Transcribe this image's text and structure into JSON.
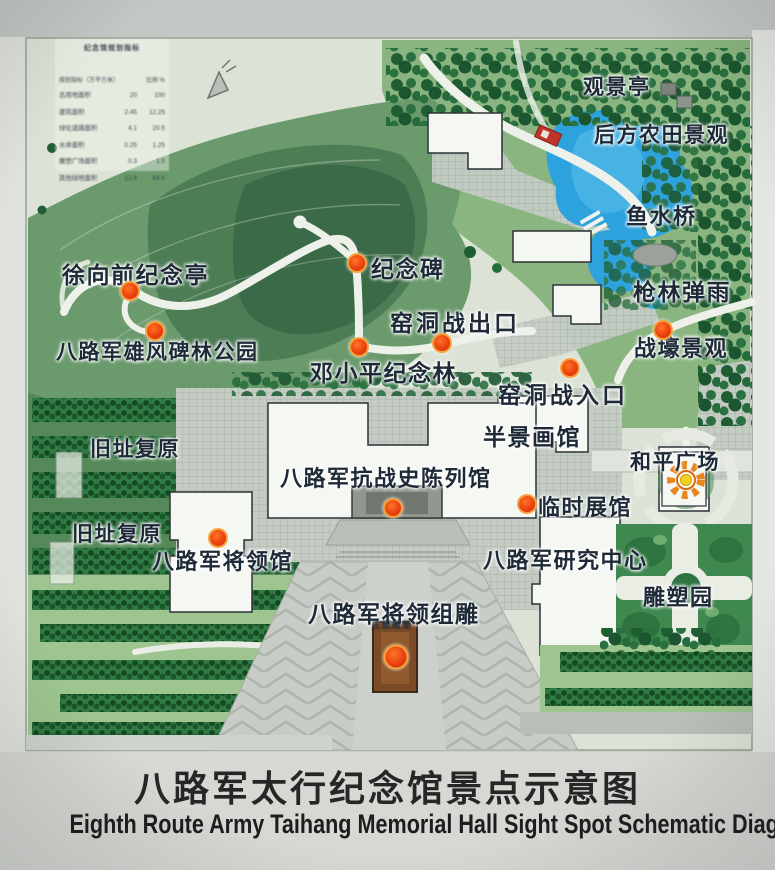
{
  "legend_table": {
    "title": "纪念馆规划指标",
    "header": {
      "name": "规划指标（万平方米）",
      "ratio": "比例 %"
    },
    "rows": [
      {
        "name": "总用地面积",
        "value": "20",
        "pct": "100"
      },
      {
        "name": "建筑面积",
        "value": "2.45",
        "pct": "12.25"
      },
      {
        "name": "绿化道路面积",
        "value": "4.1",
        "pct": "20.5"
      },
      {
        "name": "水体面积",
        "value": "0.25",
        "pct": "1.25"
      },
      {
        "name": "雕塑广场面积",
        "value": "0.3",
        "pct": "1.5"
      },
      {
        "name": "其他绿地面积",
        "value": "12.9",
        "pct": "64.5"
      }
    ]
  },
  "map": {
    "labels": [
      {
        "id": "viewing-pavilion",
        "text": "观景亭",
        "x": 583,
        "y": 71,
        "fs": 21
      },
      {
        "id": "rear-farmland-view",
        "text": "后方农田景观",
        "x": 594,
        "y": 119,
        "fs": 21
      },
      {
        "id": "fish-water-bridge",
        "text": "鱼水桥",
        "x": 626,
        "y": 199,
        "fs": 22
      },
      {
        "id": "hail-of-bullets",
        "text": "枪林弹雨",
        "x": 633,
        "y": 273,
        "fs": 23
      },
      {
        "id": "trench-landscape",
        "text": "战壕景观",
        "x": 634,
        "y": 331,
        "fs": 22
      },
      {
        "id": "monument",
        "text": "纪念碑",
        "x": 371,
        "y": 250,
        "fs": 23
      },
      {
        "id": "xuxiangqian-pavilion",
        "text": "徐向前纪念亭",
        "x": 62,
        "y": 256,
        "fs": 23
      },
      {
        "id": "cave-warfare-exit",
        "text": "窑洞战出口",
        "x": 390,
        "y": 304,
        "fs": 23,
        "ls": 3
      },
      {
        "id": "stele-forest-park",
        "text": "八路军雄风碑林公园",
        "x": 56,
        "y": 336,
        "fs": 21
      },
      {
        "id": "dengxiaoping-forest",
        "text": "邓小平纪念林",
        "x": 310,
        "y": 354,
        "fs": 23
      },
      {
        "id": "cave-warfare-entrance",
        "text": "窑洞战入口",
        "x": 498,
        "y": 376,
        "fs": 23,
        "ls": 3
      },
      {
        "id": "panorama-hall",
        "text": "半景画馆",
        "x": 483,
        "y": 418,
        "fs": 23
      },
      {
        "id": "peace-square",
        "text": "和平广场",
        "x": 630,
        "y": 446,
        "fs": 21
      },
      {
        "id": "former-site-1",
        "text": "旧址复原",
        "x": 90,
        "y": 433,
        "fs": 21
      },
      {
        "id": "war-history-hall",
        "text": "八路军抗战史陈列馆",
        "x": 280,
        "y": 461,
        "fs": 22
      },
      {
        "id": "temporary-hall",
        "text": "临时展馆",
        "x": 538,
        "y": 490,
        "fs": 22
      },
      {
        "id": "former-site-2",
        "text": "旧址复原",
        "x": 72,
        "y": 518,
        "fs": 21
      },
      {
        "id": "generals-hall",
        "text": "八路军将领馆",
        "x": 152,
        "y": 544,
        "fs": 22
      },
      {
        "id": "research-center",
        "text": "八路军研究中心",
        "x": 483,
        "y": 543,
        "fs": 22
      },
      {
        "id": "sculpture-garden",
        "text": "雕塑园",
        "x": 643,
        "y": 580,
        "fs": 22
      },
      {
        "id": "generals-group-sculpture",
        "text": "八路军将领组雕",
        "x": 308,
        "y": 595,
        "fs": 23
      }
    ],
    "dots": [
      {
        "x": 130,
        "y": 291
      },
      {
        "x": 155,
        "y": 331
      },
      {
        "x": 357,
        "y": 263
      },
      {
        "x": 442,
        "y": 343
      },
      {
        "x": 359,
        "y": 347
      },
      {
        "x": 570,
        "y": 368
      },
      {
        "x": 663,
        "y": 330
      },
      {
        "x": 393,
        "y": 508
      },
      {
        "x": 527,
        "y": 504
      },
      {
        "x": 218,
        "y": 538
      },
      {
        "x": 396,
        "y": 657,
        "s": 21
      }
    ],
    "sub_label": "主题雕塑"
  },
  "title": {
    "zh": "八路军太行纪念馆景点示意图",
    "en": "Eighth Route Army Taihang Memorial Hall Sight Spot Schematic Diagram"
  },
  "colors": {
    "grass": "#8ab580",
    "hill": "#6b9a6d",
    "forest_dark": "#1f5e33",
    "lake": "#2ea2dc",
    "plaza": "#c5cdc5",
    "dot_orange": "#ea4110",
    "building": "#f5f7f3",
    "monument_brown": "#7b4a26"
  }
}
